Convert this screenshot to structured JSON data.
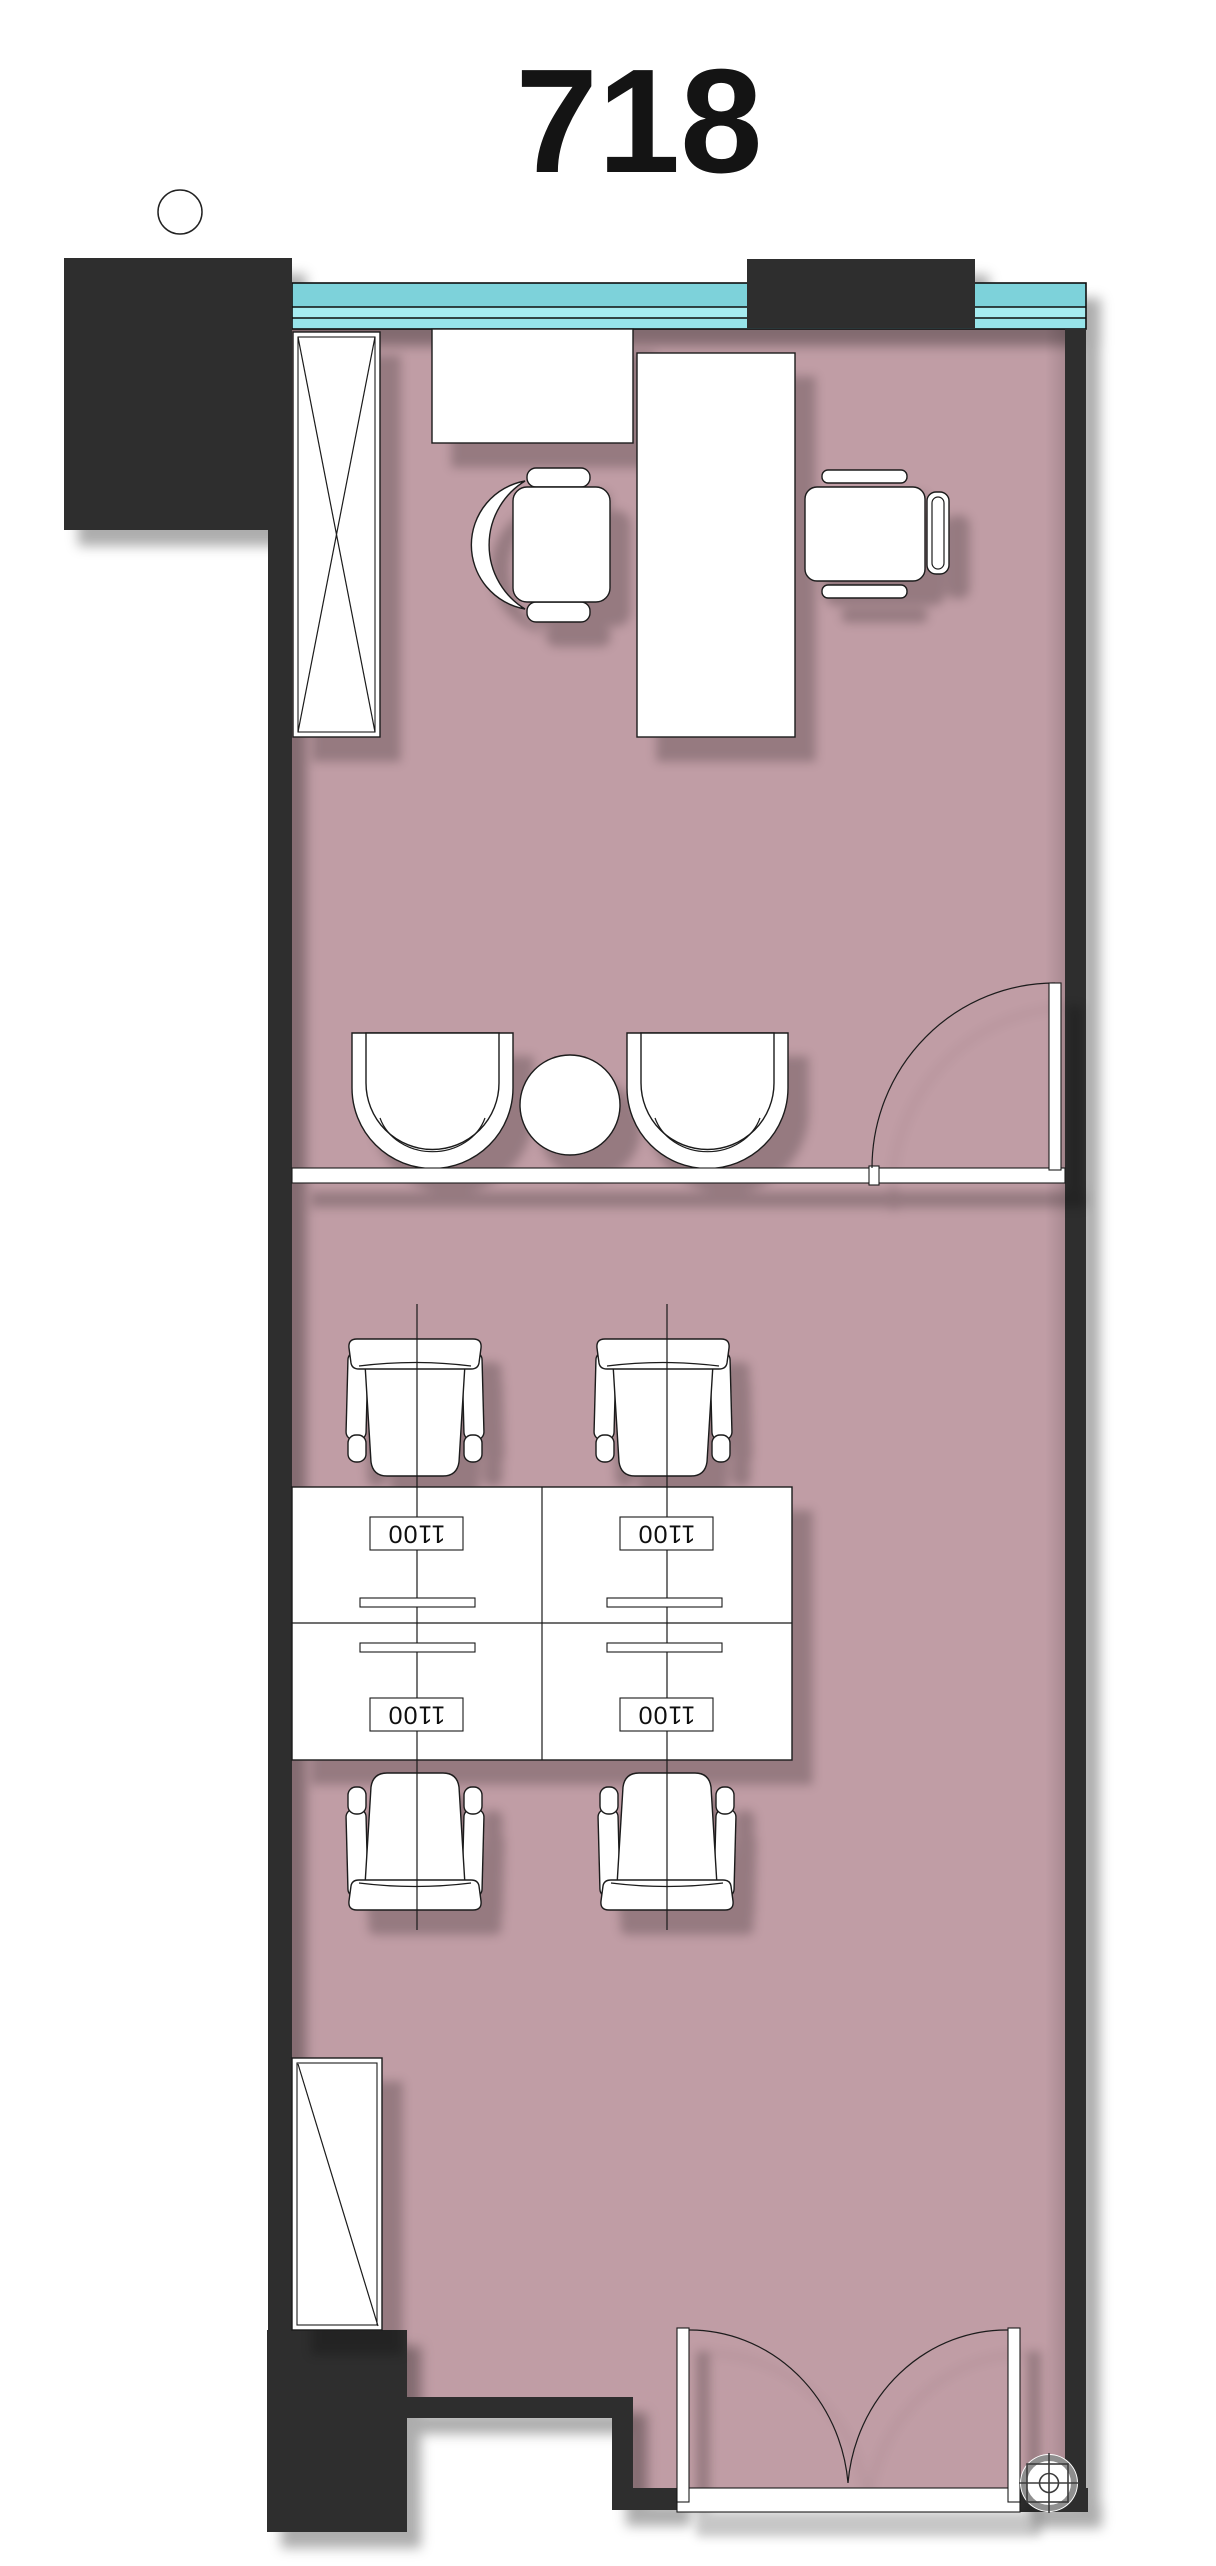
{
  "title": {
    "room_number": "718"
  },
  "workstations": {
    "desks": [
      {
        "label": "1100"
      },
      {
        "label": "1100"
      },
      {
        "label": "1100"
      },
      {
        "label": "1100"
      }
    ]
  },
  "colors": {
    "floor": "#c09da5",
    "wall": "#2e2e2e",
    "outline": "#1a1a1a",
    "furniture": "#ffffff",
    "glass_top": "#7dd2da",
    "glass_mid": "#97e4ea",
    "glass_light": "#a6ecf1"
  }
}
